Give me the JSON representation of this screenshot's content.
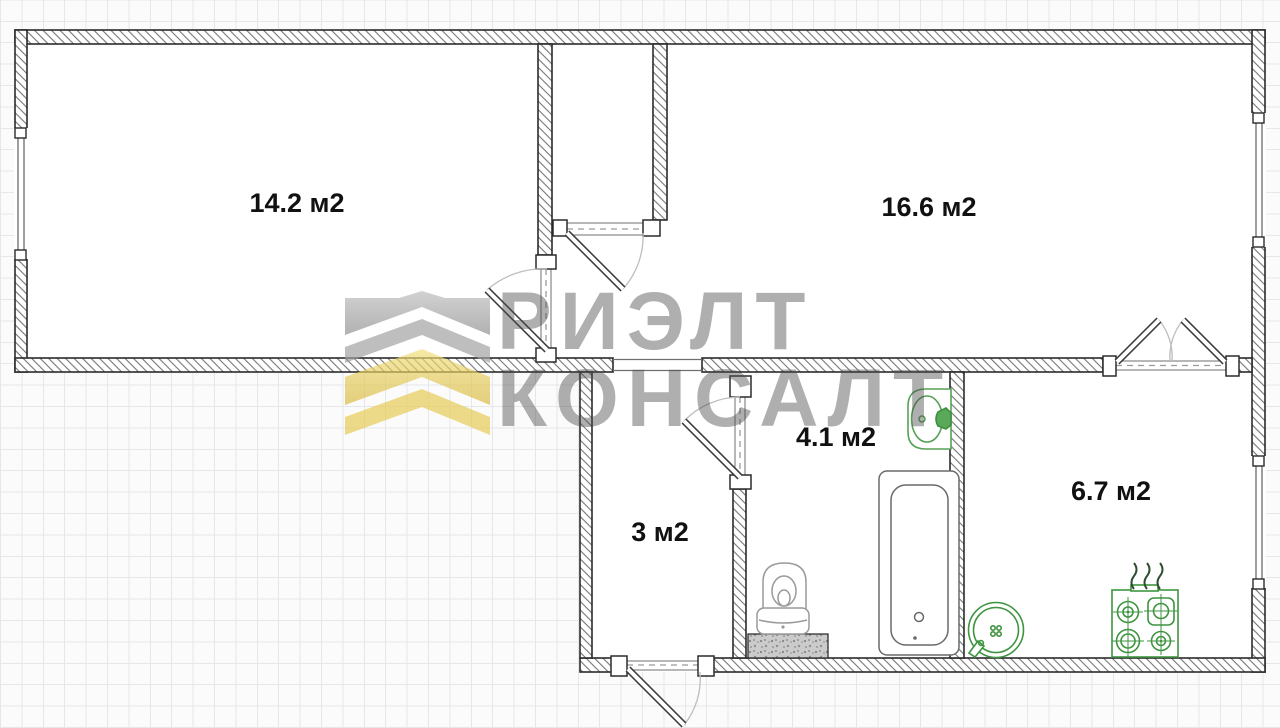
{
  "title": "Apartment floor plan",
  "watermark": {
    "word1": "РИЭЛТ",
    "word2": "КОНСАЛТ",
    "logo_gray": "#9a9a9a",
    "logo_yellow": "#dfc04a"
  },
  "rooms": [
    {
      "name": "living-room-1",
      "area_label": "14.2 м2"
    },
    {
      "name": "living-room-2",
      "area_label": "16.6 м2"
    },
    {
      "name": "bathroom",
      "area_label": "4.1 м2"
    },
    {
      "name": "hallway",
      "area_label": "3 м2"
    },
    {
      "name": "kitchen",
      "area_label": "6.7 м2"
    }
  ],
  "fixtures": [
    {
      "name": "bathtub"
    },
    {
      "name": "toilet"
    },
    {
      "name": "wash-basin"
    },
    {
      "name": "kitchen-sink"
    },
    {
      "name": "gas-stove"
    },
    {
      "name": "vent-shaft"
    }
  ],
  "colors": {
    "wall_outline": "#2b2b2b",
    "hatch_line": "#767676",
    "fixture_green": "#3f9440",
    "plumbing_gray": "#8e8e8e",
    "grid_line": "#e6e7ea",
    "label_black": "#111111"
  }
}
